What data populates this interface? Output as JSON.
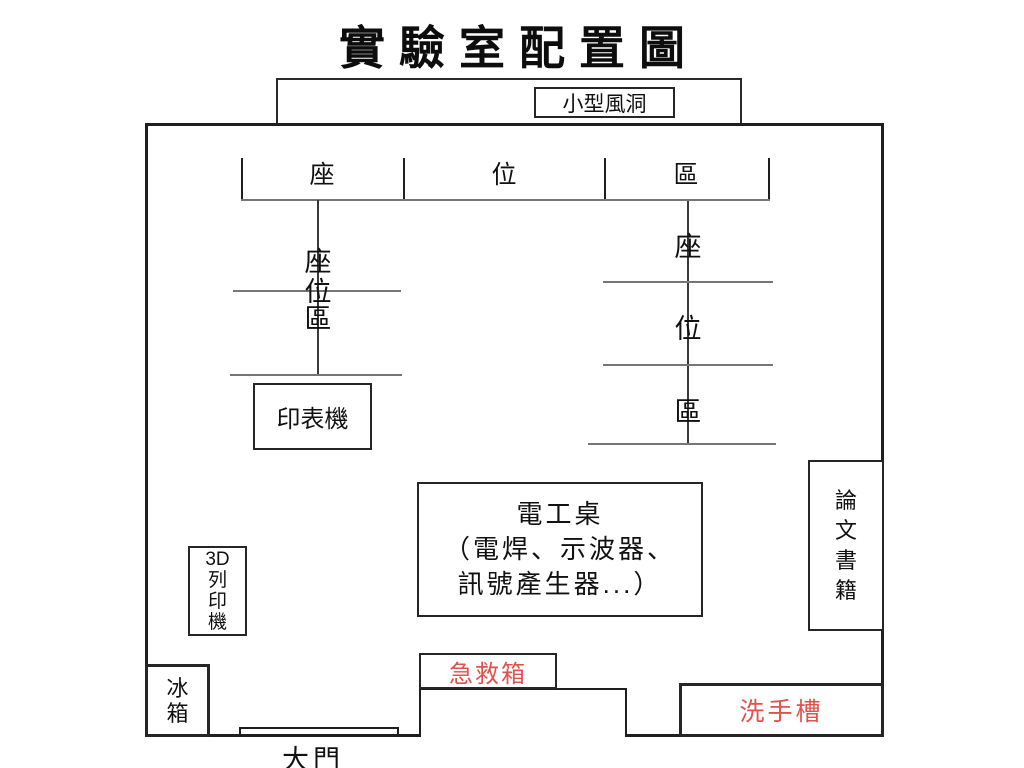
{
  "title": "實驗室配置圖",
  "colors": {
    "background": "#ffffff",
    "wall_line": "#1f1f1f",
    "thin_line": "#767676",
    "red_label": "#e0524e"
  },
  "areas": {
    "wind_tunnel": "小型風洞",
    "seating_bar": [
      "座",
      "位",
      "區"
    ],
    "left_seating": [
      "座",
      "位",
      "區"
    ],
    "right_seating": [
      "座",
      "位",
      "區"
    ],
    "printer": "印表機",
    "workbench": [
      "電工桌",
      "（電焊、示波器、",
      "訊號產生器...）"
    ],
    "books": [
      "論",
      "文",
      "書",
      "籍"
    ],
    "printer_3d": [
      "3D",
      "列",
      "印",
      "機"
    ],
    "fridge": [
      "冰",
      "箱"
    ],
    "first_aid": "急救箱",
    "sink": "洗手槽",
    "door": "大門"
  }
}
